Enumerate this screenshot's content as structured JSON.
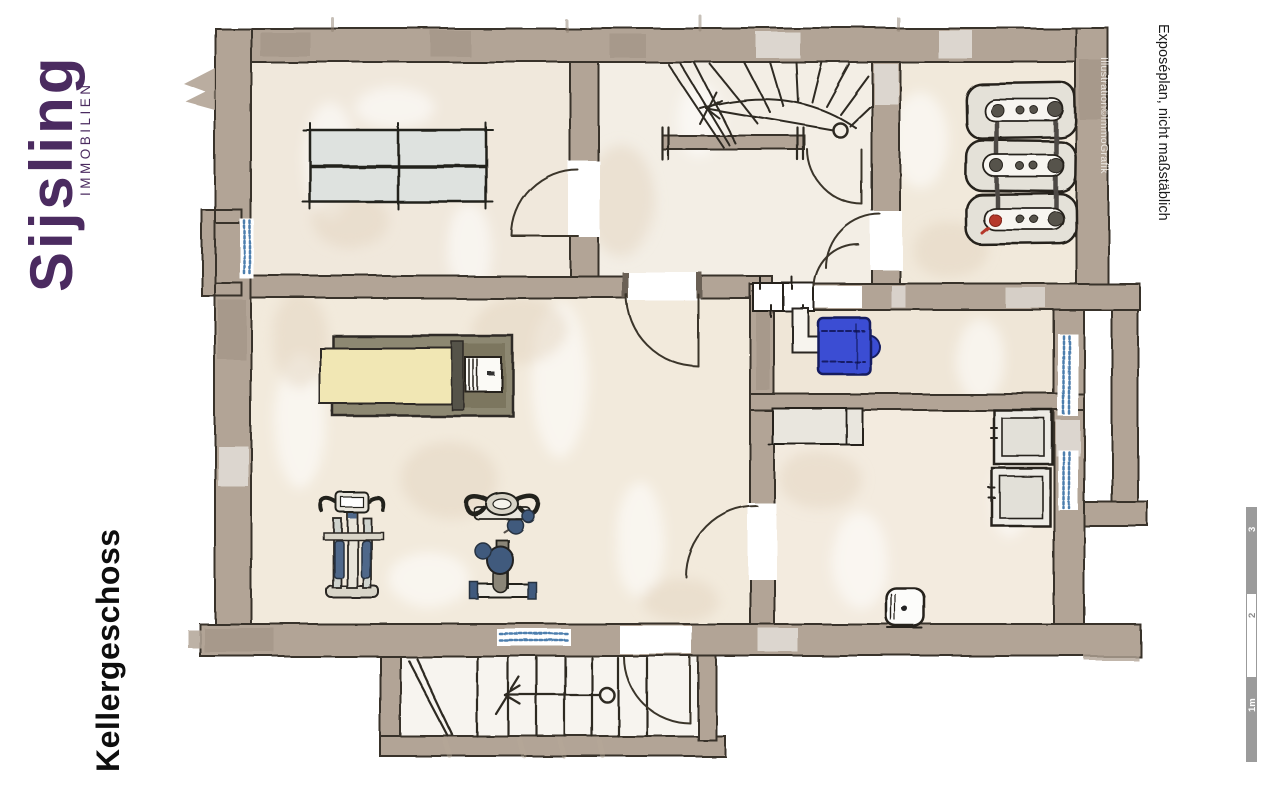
{
  "branding": {
    "logo_text": "Sijsling",
    "logo_subtext": "IMMOBILIEN",
    "logo_color": "#4b2b60"
  },
  "labels": {
    "floor_name": "Kellergeschoss",
    "disclaimer": "Exposéplan, nicht maßstäblich",
    "credit": "Illustration©ImmoGrafik"
  },
  "scale_bar": {
    "labels": [
      "1m",
      "2",
      "3"
    ],
    "bar_color": "#9b9b9b"
  },
  "palette": {
    "wall": "#b2a496",
    "wall_edge": "#38322a",
    "floor_beige": "#f2eadc",
    "window_blue": "#4d7fae",
    "appliance_blue": "#3b4ed3",
    "equipment_blue": "#3f5a7d",
    "mattress_yellow": "#f1e7b4",
    "boiler_red": "#b5392c"
  },
  "plan": {
    "type": "hand-drawn basement floor plan",
    "elements": [
      "table-tennis-table",
      "winder-staircase",
      "stair-railing",
      "heating-unit",
      "chimney",
      "flue-duct",
      "water-softener",
      "laundry-counter",
      "washing-machine",
      "dryer",
      "wash-basin",
      "solarium-bed",
      "elliptical-trainer",
      "exercise-bike",
      "exterior-cellar-staircase",
      "light-wells",
      "windows",
      "door-swings"
    ]
  }
}
